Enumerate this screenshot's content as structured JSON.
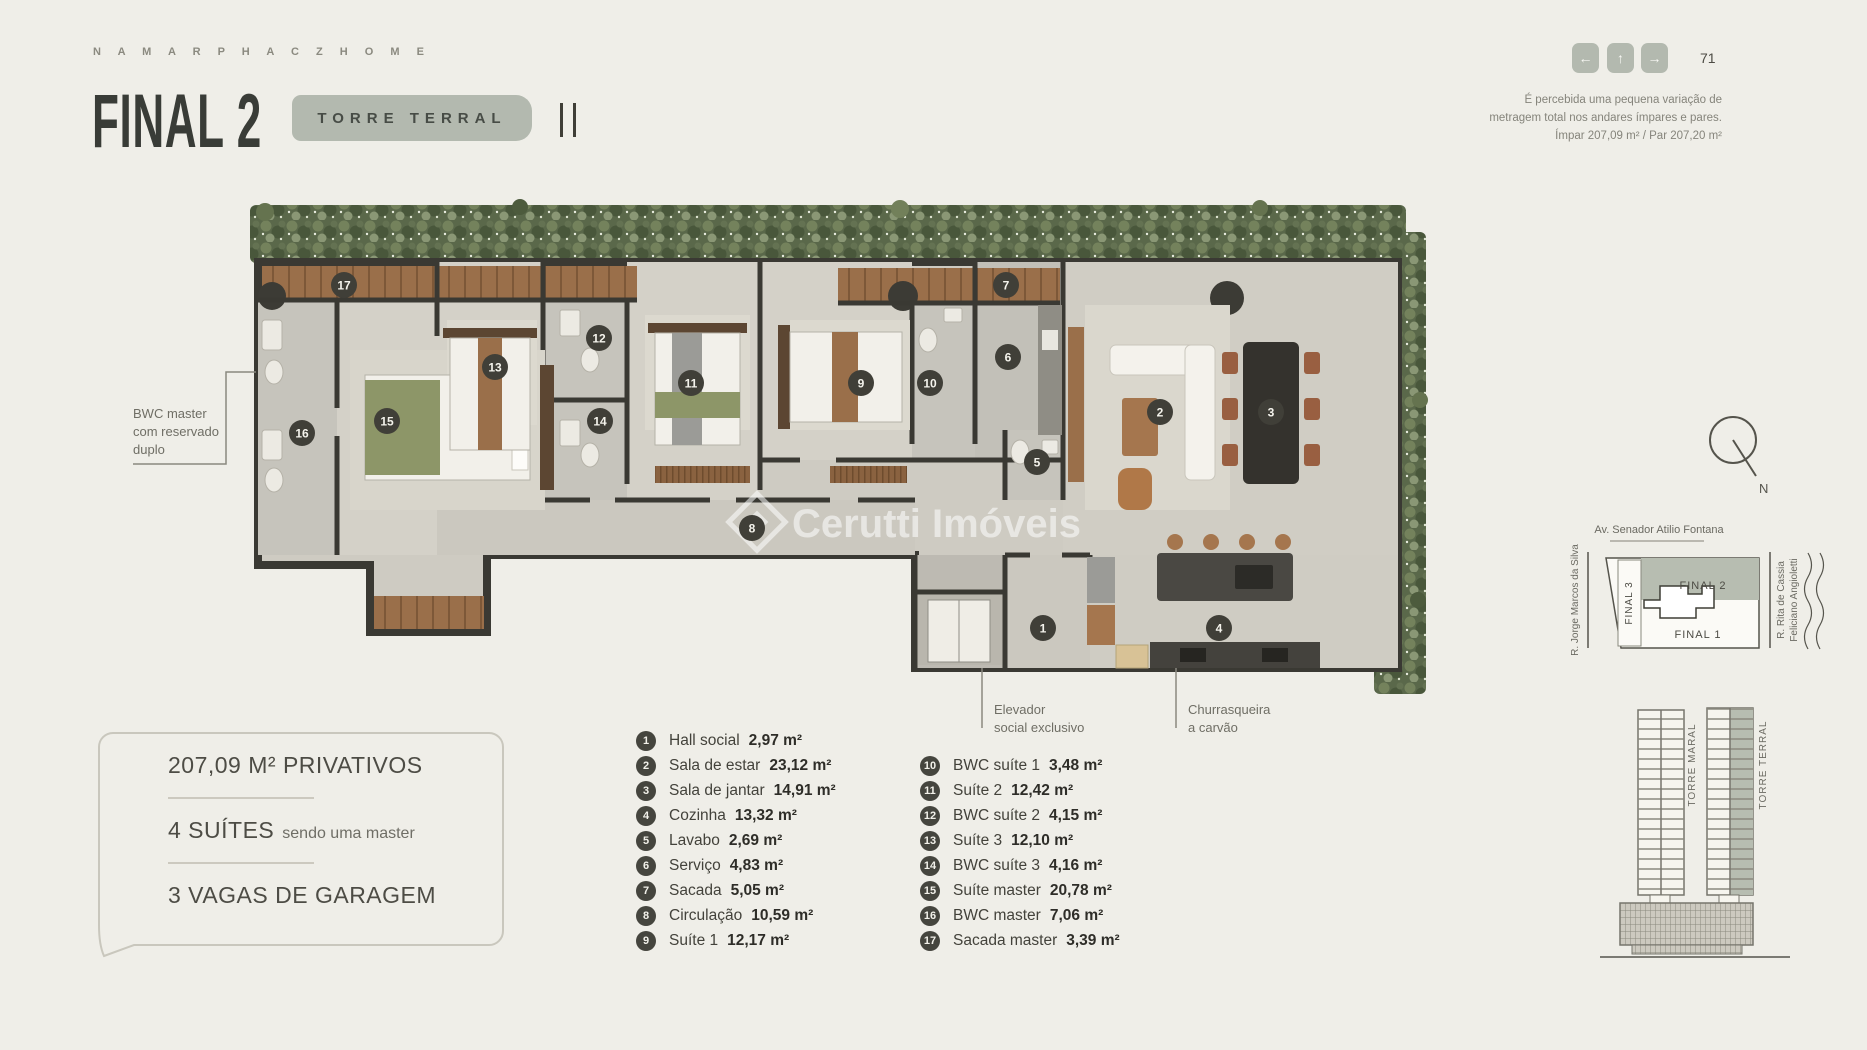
{
  "header": {
    "brand": "N A M A R   P H A C Z   H O M E",
    "title": "FINAL 2",
    "tower_badge": "TORRE TERRAL",
    "page_number": "71",
    "nav": {
      "back": "←",
      "up": "↑",
      "forward": "→"
    },
    "note_line1": "É percebida uma pequena variação de",
    "note_line2": "metragem total nos andares ímpares e pares.",
    "note_line3": "Ímpar 207,09 m² /  Par 207,20 m²"
  },
  "summary_box": {
    "area": "207,09 M² PRIVATIVOS",
    "suites_main": "4 SUÍTES",
    "suites_sub": "sendo uma master",
    "garage": "3 VAGAS DE GARAGEM"
  },
  "watermark": "Cerutti Imóveis",
  "callouts": {
    "bwc_master": [
      "BWC master",
      "com reservado",
      "duplo"
    ],
    "elevator": [
      "Elevador",
      "social exclusivo"
    ],
    "barbecue": [
      "Churrasqueira",
      "a carvão"
    ]
  },
  "legend": {
    "left": [
      {
        "n": "1",
        "label": "Hall social",
        "value": "2,97 m²"
      },
      {
        "n": "2",
        "label": "Sala de estar",
        "value": "23,12 m²"
      },
      {
        "n": "3",
        "label": "Sala de jantar",
        "value": "14,91 m²"
      },
      {
        "n": "4",
        "label": "Cozinha",
        "value": "13,32 m²"
      },
      {
        "n": "5",
        "label": "Lavabo",
        "value": "2,69 m²"
      },
      {
        "n": "6",
        "label": "Serviço",
        "value": "4,83 m²"
      },
      {
        "n": "7",
        "label": "Sacada",
        "value": "5,05 m²"
      },
      {
        "n": "8",
        "label": "Circulação",
        "value": "10,59 m²"
      },
      {
        "n": "9",
        "label": "Suíte 1",
        "value": "12,17 m²"
      }
    ],
    "right": [
      {
        "n": "10",
        "label": "BWC suíte 1",
        "value": "3,48 m²"
      },
      {
        "n": "11",
        "label": "Suíte 2",
        "value": "12,42 m²"
      },
      {
        "n": "12",
        "label": "BWC suíte 2",
        "value": "4,15 m²"
      },
      {
        "n": "13",
        "label": "Suíte 3",
        "value": "12,10 m²"
      },
      {
        "n": "14",
        "label": "BWC suíte 3",
        "value": "4,16 m²"
      },
      {
        "n": "15",
        "label": "Suíte master",
        "value": "20,78 m²"
      },
      {
        "n": "16",
        "label": "BWC master",
        "value": "7,06 m²"
      },
      {
        "n": "17",
        "label": "Sacada master",
        "value": "3,39 m²"
      }
    ]
  },
  "plan_markers": [
    {
      "n": "1",
      "x": 1043,
      "y": 628
    },
    {
      "n": "2",
      "x": 1160,
      "y": 412
    },
    {
      "n": "3",
      "x": 1271,
      "y": 412
    },
    {
      "n": "4",
      "x": 1219,
      "y": 628
    },
    {
      "n": "5",
      "x": 1037,
      "y": 462
    },
    {
      "n": "6",
      "x": 1008,
      "y": 357
    },
    {
      "n": "7",
      "x": 1006,
      "y": 285
    },
    {
      "n": "8",
      "x": 752,
      "y": 528
    },
    {
      "n": "9",
      "x": 861,
      "y": 383
    },
    {
      "n": "10",
      "x": 930,
      "y": 383
    },
    {
      "n": "11",
      "x": 691,
      "y": 383
    },
    {
      "n": "12",
      "x": 599,
      "y": 338
    },
    {
      "n": "13",
      "x": 495,
      "y": 367
    },
    {
      "n": "14",
      "x": 600,
      "y": 421
    },
    {
      "n": "15",
      "x": 387,
      "y": 421
    },
    {
      "n": "16",
      "x": 302,
      "y": 433
    },
    {
      "n": "17",
      "x": 344,
      "y": 285
    }
  ],
  "site_map": {
    "street_top": "Av. Senador Atilio Fontana",
    "street_left": "R. Jorge Marcos da Silva",
    "street_right_line1": "R. Rita de Cassia",
    "street_right_line2": "Feliciano Angioletti",
    "unit_highlight": "FINAL 2",
    "unit_below": "FINAL 1",
    "unit_left": "FINAL 3",
    "north_label": "N"
  },
  "towers": {
    "left": "TORRE MARAL",
    "right": "TORRE TERRAL"
  },
  "colors": {
    "background": "#efeee8",
    "accent_badge": "#b3b9af",
    "title": "#393c37",
    "wall": "#3a3933",
    "floor": "#cecbc2",
    "wood": "#9a6f4a",
    "hedge": "#5a684a",
    "marker": "#45453e"
  }
}
